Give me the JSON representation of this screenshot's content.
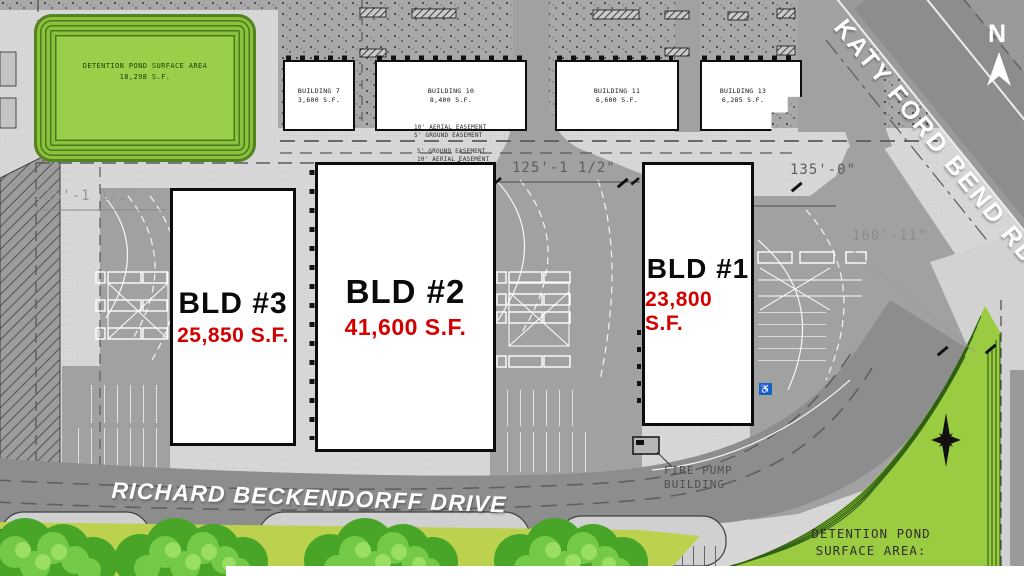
{
  "compass": {
    "north_label": "N"
  },
  "roads": {
    "katy_ford_bend": "KATY FORD BEND RD",
    "richard_beckendorff": "RICHARD BECKENDORFF DRIVE"
  },
  "detention_pond_top_left": {
    "title": "DETENTION POND SURFACE AREA",
    "area": "18,298 S.F."
  },
  "detention_pond_bottom_right": {
    "line1": "DETENTION POND",
    "line2": "SURFACE AREA:"
  },
  "small_buildings": [
    {
      "name": "BUILDING 7",
      "area": "3,600 S.F."
    },
    {
      "name": "BUILDING 10",
      "area": "8,400 S.F."
    },
    {
      "name": "BUILDING 11",
      "area": "6,600 S.F."
    },
    {
      "name": "BUILDING 13",
      "area": "6,285 S.F."
    }
  ],
  "main_buildings": [
    {
      "name": "BLD #3",
      "area": "25,850 S.F."
    },
    {
      "name": "BLD #2",
      "area": "41,600 S.F."
    },
    {
      "name": "BLD #1",
      "area": "23,800 S.F."
    }
  ],
  "dimensions": {
    "west": "125'-1 1/2\"",
    "center": "125'-1 1/2\"",
    "east": "135'-0\"",
    "southeast": "160'-11\""
  },
  "easements": {
    "north_line1": "10' AERIAL EASEMENT",
    "north_line2": "5' GROUND EASEMENT",
    "south_line1": "5' GROUND EASEMENT",
    "south_line2": "10' AERIAL EASEMENT"
  },
  "fire_pump_building": {
    "line1": "FIRE PUMP",
    "line2": "BUILDING"
  },
  "accessible_parking_symbol": "♿",
  "colors": {
    "area_text_red": "#d40000",
    "pond_green": "#9bcb40",
    "grass_green": "#bcd24f",
    "road_gray": "#8d8d8d",
    "paving_gray": "#a1a1a1",
    "background_gray": "#d7d7d7",
    "handicap_blue": "#1565c0"
  }
}
